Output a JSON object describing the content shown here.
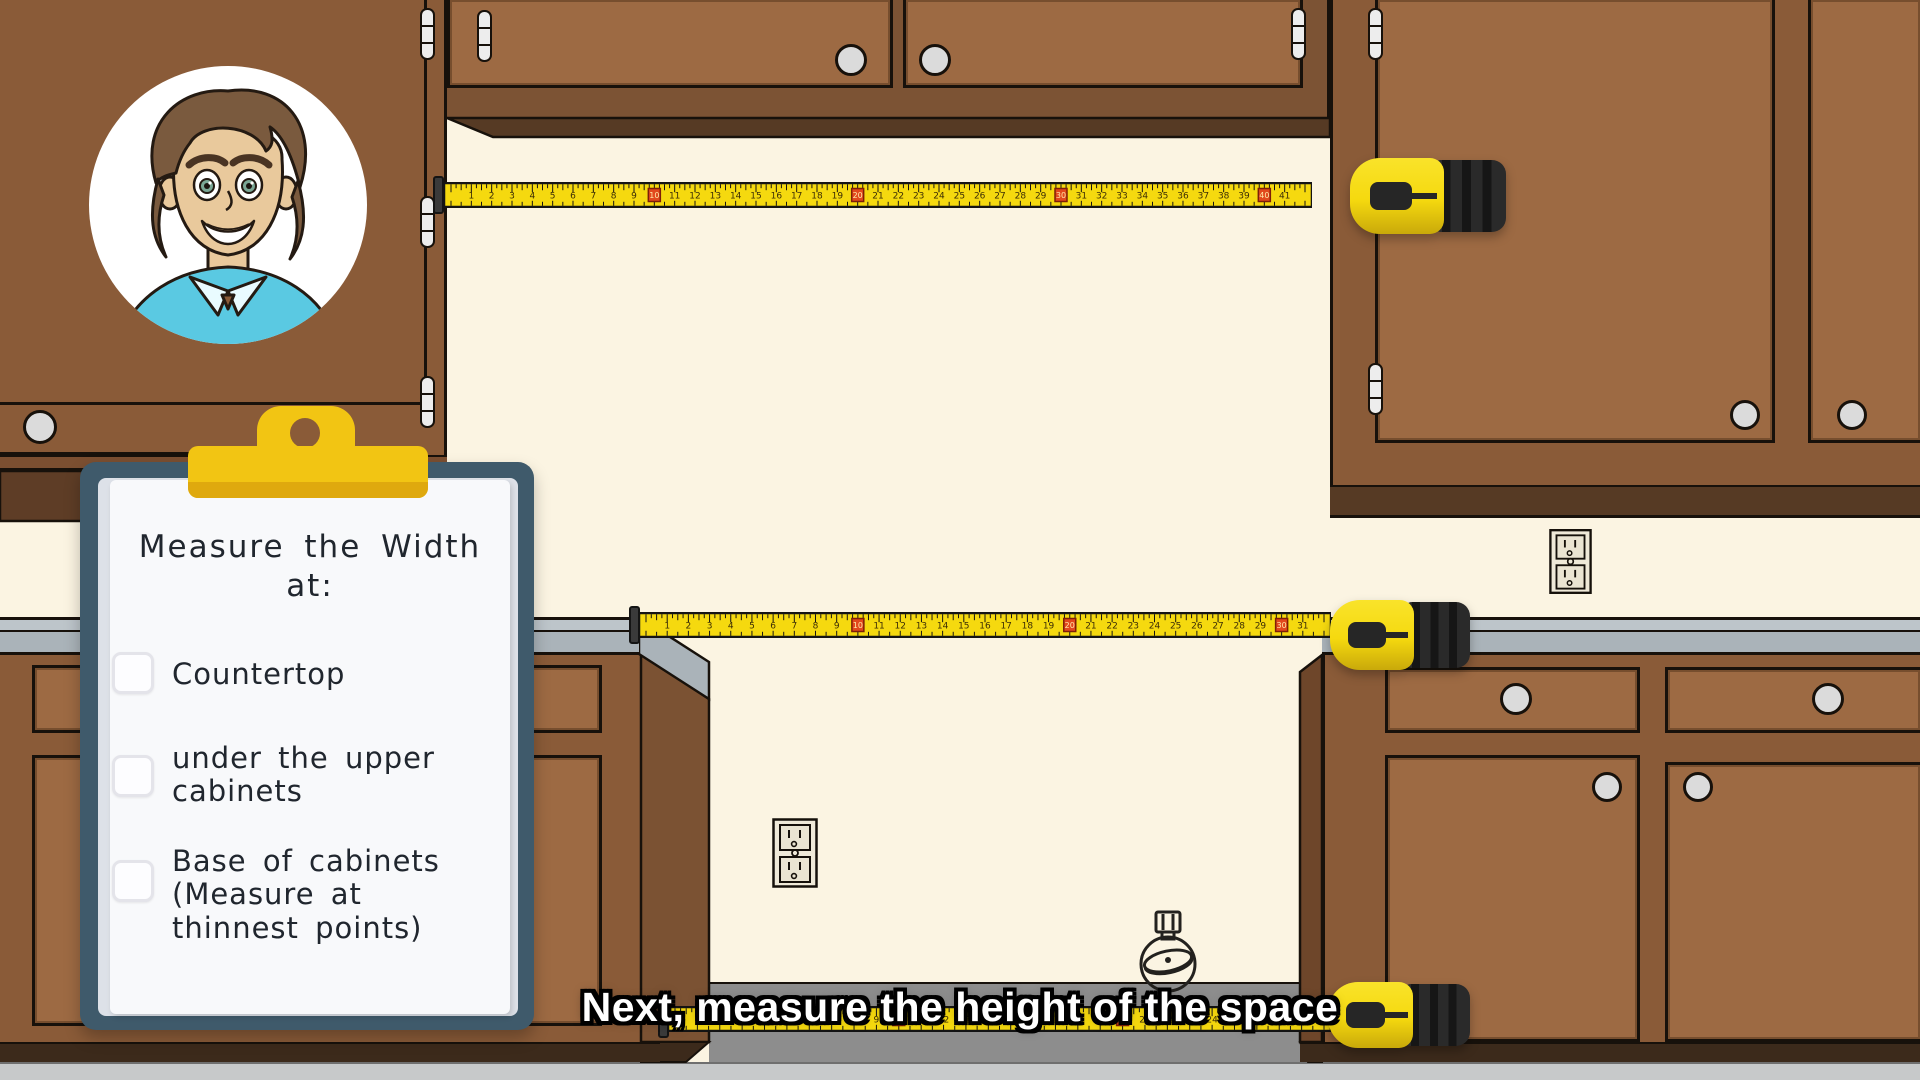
{
  "caption": {
    "text": "Next, measure the height of the space"
  },
  "clipboard": {
    "title": "Measure the Width",
    "title_suffix": "at:",
    "items": [
      {
        "label": "Countertop",
        "checked": false
      },
      {
        "label": "under the upper cabinets",
        "checked": false
      },
      {
        "label": "Base of cabinets (Measure at thinnest points)",
        "checked": false
      }
    ]
  },
  "tapes": [
    {
      "id": "upper-cabinet-gap",
      "first_number": 1,
      "last_number": 41,
      "marker_every": 10
    },
    {
      "id": "countertop-gap",
      "first_number": 1,
      "last_number": 31,
      "marker_every": 10
    },
    {
      "id": "cabinet-base-gap",
      "first_number": 1,
      "last_number": 28,
      "marker_every": 10
    }
  ],
  "icons": {
    "outlet": "power-outlet-icon",
    "hookup": "appliance-hookup-icon",
    "clip": "clipboard-clip",
    "tape": "tape-measure"
  },
  "palette": {
    "wall": "#fbf4e2",
    "cabinet": "#8a5b38",
    "cabinet-panel": "#9d6a43",
    "cabinet-frame": "#7c5334",
    "cabinet-dark": "#563a24",
    "cabinet-side": "#6e462a",
    "under-cabinet": "#5e3d26",
    "counter-light": "#bdc5ca",
    "counter-med": "#aab3b9",
    "floor": "#c7c9ca",
    "gap-floor": "#8d8d8d",
    "toe-kick": "#3c2a1b",
    "outline": "#17110b",
    "tape-yellow": "#f5d90f",
    "tape-marker": "#e2491d",
    "board": "#3f5a6b",
    "clip": "#f2c513",
    "clip-dark": "#dfa90e",
    "paper": "#f8f9fb",
    "ink": "#20262e",
    "knob": "#dbdbdb",
    "shirt": "#5ac9e2",
    "skin": "#e9c99c",
    "hair": "#7a5a3e"
  }
}
